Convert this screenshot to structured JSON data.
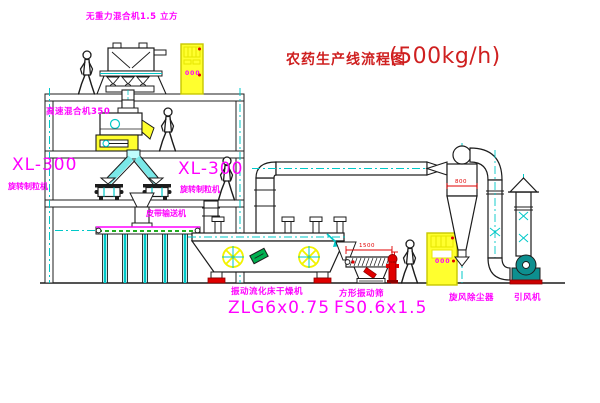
{
  "title": {
    "name": "农药生产线流程图",
    "capacity": "(500kg/h)"
  },
  "equipment_labels": {
    "gravity_mixer": "无重力混合机1.5 立方",
    "high_speed_mixer": "高速混合机350",
    "granulator_left": {
      "model": "XL-300",
      "name": "旋转制粒机"
    },
    "granulator_right": {
      "model": "XL-300",
      "name": "旋转制粒机"
    },
    "belt_conveyor": "皮带输送机",
    "fluid_bed_dryer": {
      "name": "振动流化床干燥机",
      "model": "ZLG6x0.75"
    },
    "vibrating_sieve": {
      "name": "方形振动筛",
      "model": "FS0.6x1.5"
    },
    "cyclone": "旋风除尘器",
    "induced_draft_fan": "引风机"
  },
  "dimensions": {
    "cyclone_diameter": "800",
    "sieve_length": "1500",
    "sieve_height": "745"
  },
  "control_panels": {
    "panel_top": "000",
    "panel_ground": "000"
  },
  "colors": {
    "line": "#1c1c1c",
    "centerline_cyan": "#00c8c8",
    "highlight_yellow": "#ffff00",
    "label_magenta": "#ff00ff",
    "accent_red": "#e00000",
    "title_red": "#cf2020",
    "detail_green": "#00a000",
    "fan_teal": "#0d8f8f"
  }
}
